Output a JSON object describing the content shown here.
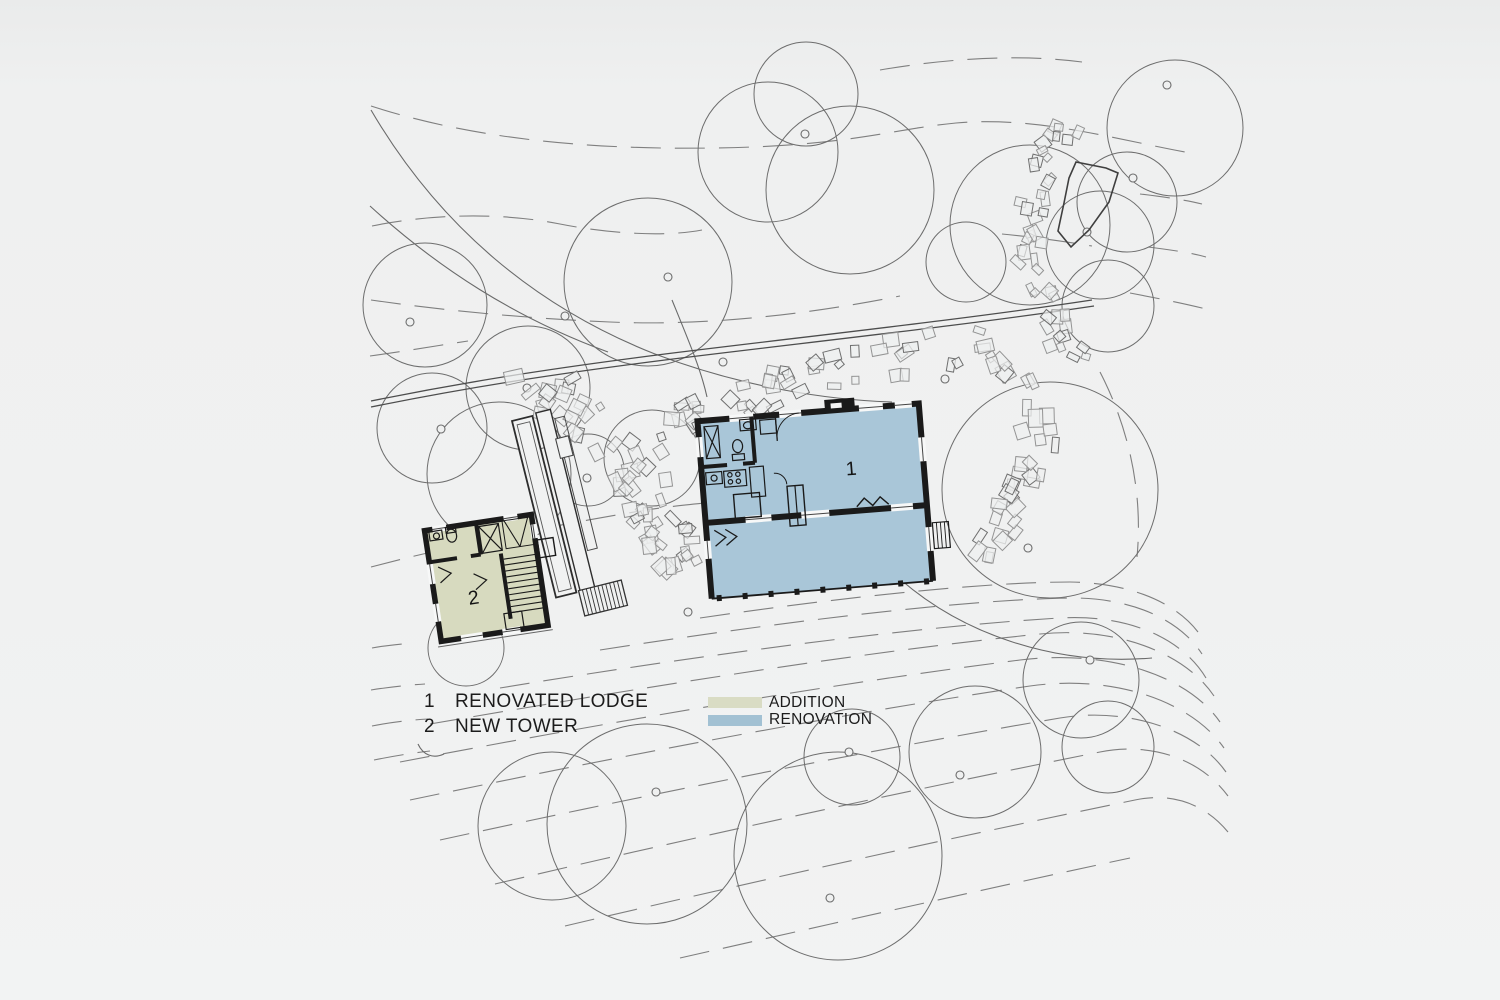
{
  "legend": {
    "items": [
      {
        "number": "1",
        "label": "RENOVATED LODGE"
      },
      {
        "number": "2",
        "label": "NEW TOWER"
      }
    ],
    "swatches": [
      {
        "label": "ADDITION",
        "color": "#d9dcc4"
      },
      {
        "label": "RENOVATION",
        "color": "#a2c1d3"
      }
    ]
  },
  "buildings": {
    "lodge_label": "1",
    "tower_label": "2"
  },
  "colors": {
    "addition": "#d7dabf",
    "renovation": "#a9c6d8",
    "wall": "#1a1a1a",
    "background": "#eff0f0"
  }
}
